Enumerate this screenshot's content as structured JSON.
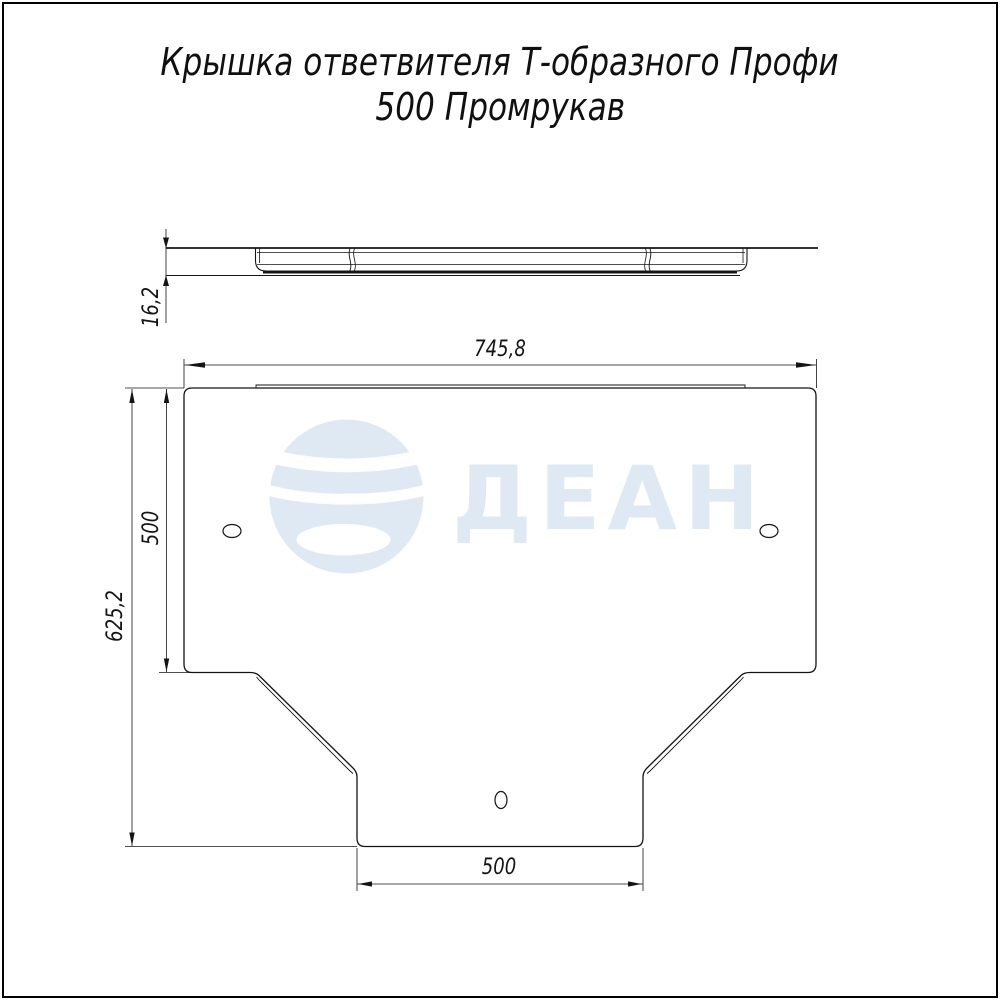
{
  "sheet": {
    "background": "#ffffff",
    "border_color": "#000000",
    "line_color": "#141414"
  },
  "title": {
    "line1": "Крышка ответвителя Т-образного Профи",
    "line2": "500 Промрукав"
  },
  "watermark": {
    "brand": "ДЕАН",
    "color": "#dfe9f3"
  },
  "drawing": {
    "side_view": {
      "dim_thickness": "16,2"
    },
    "plan_view": {
      "dim_width": "745,8",
      "dim_flange_height": "500",
      "dim_total_height": "625,2",
      "dim_bottom_width": "500"
    }
  }
}
